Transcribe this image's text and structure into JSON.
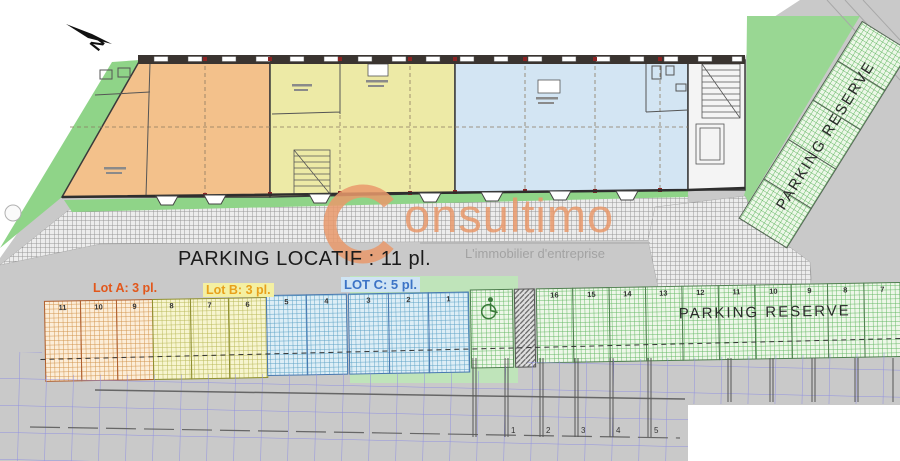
{
  "north": {
    "label": "N"
  },
  "watermark": {
    "initial": "C",
    "name": "onsultimo",
    "tagline": "L'immobilier d'entreprise"
  },
  "parking_locatif": {
    "title": "PARKING LOCATIF : 11 pl.",
    "lot_a_label": "Lot A: 3 pl.",
    "lot_b_label": "Lot B: 3 pl.",
    "lot_c_label": "LOT C: 5 pl."
  },
  "parking_reserve": {
    "row_label": "PARKING RESERVE",
    "strip_label": "PARKING RESERVE"
  },
  "space_numbers": {
    "lot_a": [
      "11",
      "10",
      "9"
    ],
    "lot_b": [
      "8",
      "7",
      "6"
    ],
    "lot_c": [
      "5",
      "4",
      "3",
      "2",
      "1"
    ],
    "reserve": [
      "16",
      "15",
      "14",
      "13",
      "12",
      "11",
      "10",
      "9",
      "8",
      "7"
    ],
    "road": [
      "1",
      "2",
      "3",
      "4",
      "5"
    ]
  },
  "colors": {
    "lot_a_text": "#e2571b",
    "lot_b_text": "#e8a11c",
    "lot_c_text": "#3c74c6",
    "building_lot_a": "#f3c18b",
    "building_lot_b": "#edeaa6",
    "building_lot_c": "#d3e5f3",
    "lawn_green": "#99d793",
    "watermark_orange": "#e9996b",
    "road_gray": "#c9c9c9"
  }
}
